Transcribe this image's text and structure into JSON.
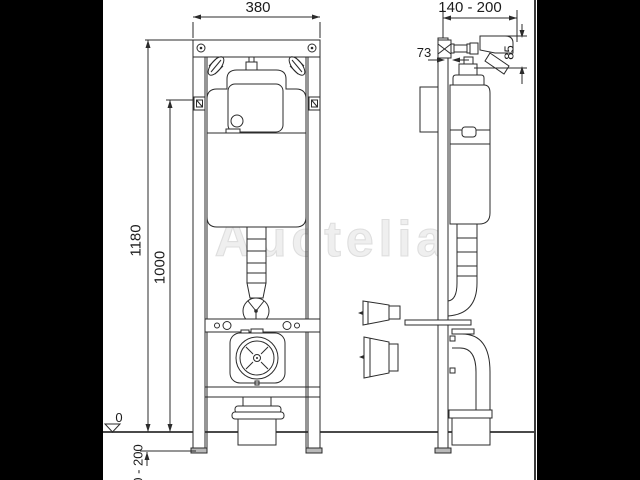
{
  "colors": {
    "background": "#000000",
    "paper": "#ffffff",
    "line": "#2b2b2b",
    "floor_line": "#4a4a4a",
    "watermark": "#e5e5e5"
  },
  "labels": {
    "front_width": "380",
    "wall_distance_range": "140 - 200",
    "rail_depth": "73",
    "actuator_offset": "85",
    "frame_height": "1180",
    "flush_height": "1000",
    "floor_level": "0",
    "foot_adjustment_range": "0 - 200"
  },
  "watermark": {
    "text": "Auctelia"
  }
}
